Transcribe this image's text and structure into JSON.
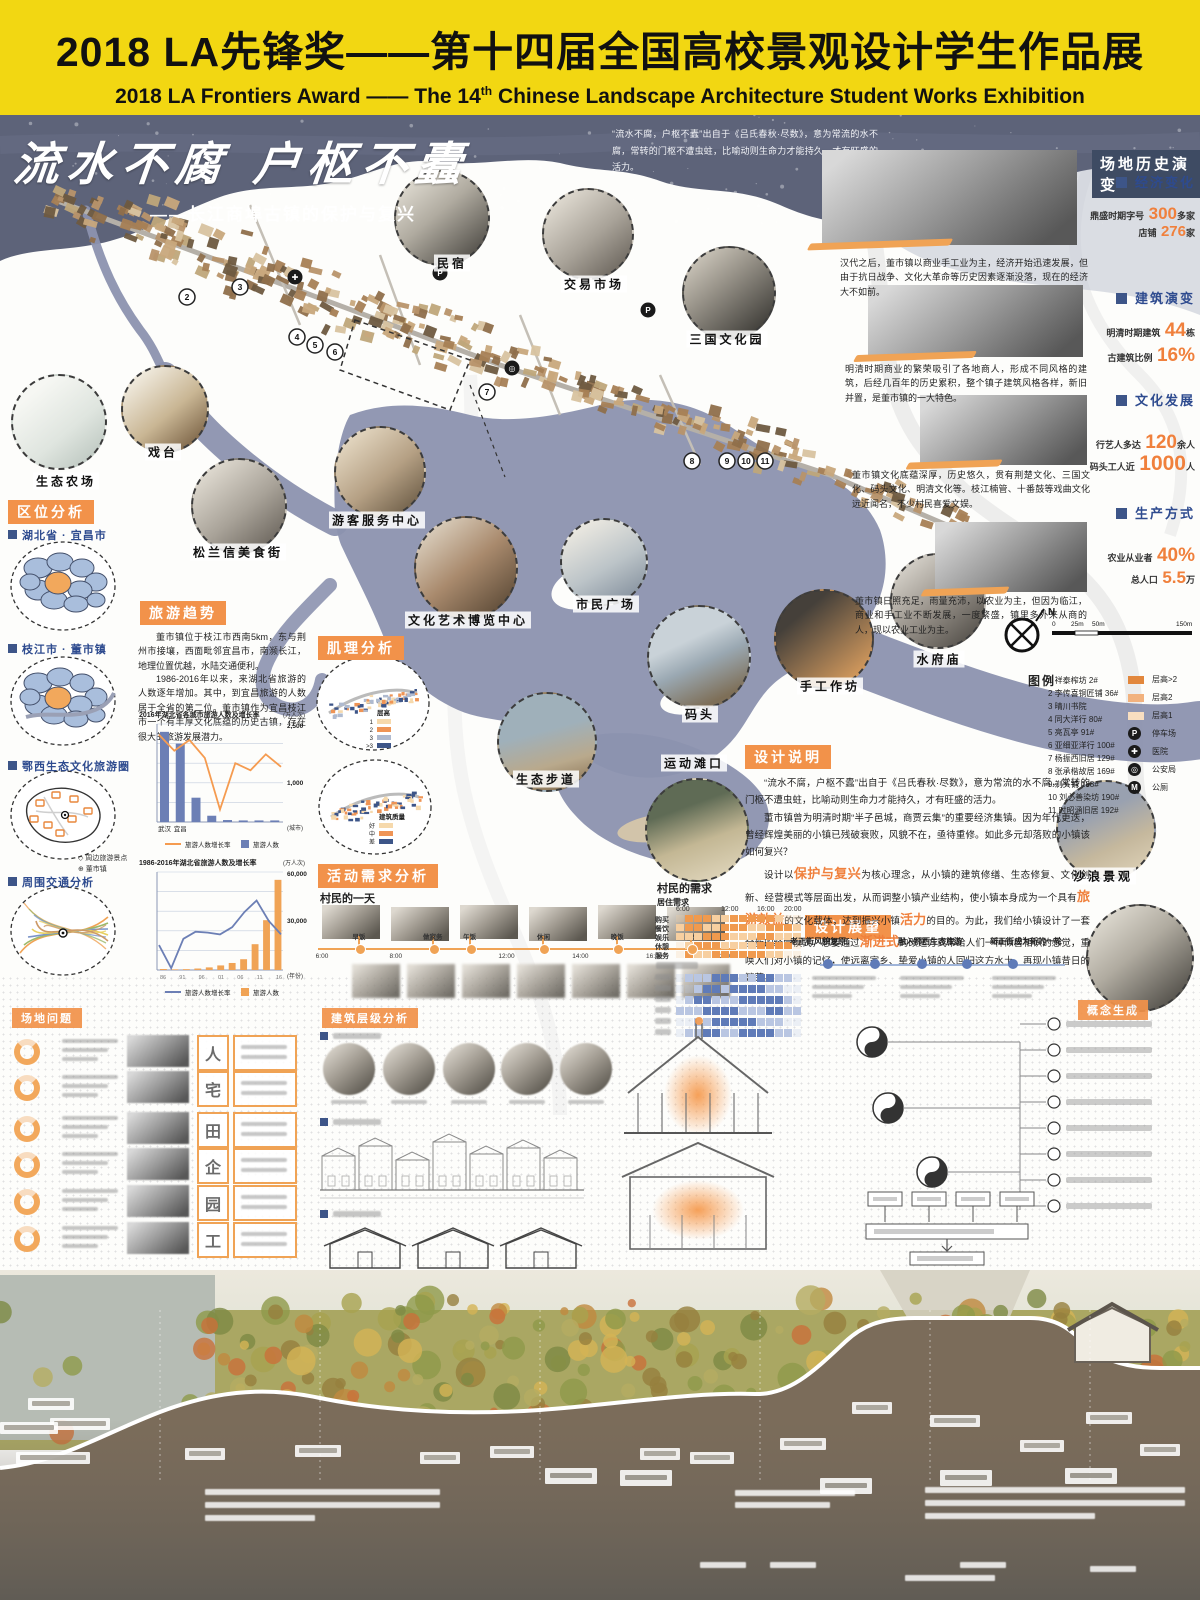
{
  "banner": {
    "title": "2018 LA先锋奖——第十四届全国高校景观设计学生作品展",
    "subtitle_pre": "2018 LA Frontiers Award —— The 14",
    "subtitle_sup": "th",
    "subtitle_post": " Chinese Landscape Architecture Student Works Exhibition",
    "bg_color": "#F2D712"
  },
  "hero": {
    "title": "流水不腐 户枢不蠹",
    "subtitle": "——长江商埠古镇的保护与复兴",
    "quote": "“流水不腐，户枢不蠹”出自于《吕氏春秋·尽数》，意为常流的水不腐，常转的门枢不遭虫蛀，比喻动则生命力才能持久，才有旺盛的活力。"
  },
  "map": {
    "callouts": [
      {
        "label": "民宿",
        "cx": 440,
        "cy": 216,
        "r": 46,
        "tone": "t-model",
        "lx": 452,
        "ly": 263
      },
      {
        "label": "交易市场",
        "cx": 586,
        "cy": 232,
        "r": 44,
        "tone": "t-gray",
        "lx": 594,
        "ly": 284
      },
      {
        "label": "三国文化园",
        "cx": 727,
        "cy": 291,
        "r": 45,
        "tone": "t-dark",
        "lx": 727,
        "ly": 339
      },
      {
        "label": "戏台",
        "cx": 163,
        "cy": 407,
        "r": 42,
        "tone": "t-pavilion",
        "lx": 163,
        "ly": 452
      },
      {
        "label": "生态农场",
        "cx": 57,
        "cy": 420,
        "r": 46,
        "tone": "t-farm",
        "lx": 66,
        "ly": 481
      },
      {
        "label": "松兰信美食街",
        "cx": 237,
        "cy": 504,
        "r": 46,
        "tone": "t-gray",
        "lx": 238,
        "ly": 552
      },
      {
        "label": "游客服务中心",
        "cx": 378,
        "cy": 470,
        "r": 44,
        "tone": "t-sepia",
        "lx": 377,
        "ly": 520
      },
      {
        "label": "文化艺术博览中心",
        "cx": 464,
        "cy": 566,
        "r": 50,
        "tone": "t-brick",
        "lx": 468,
        "ly": 620
      },
      {
        "label": "市民广场",
        "cx": 602,
        "cy": 560,
        "r": 42,
        "tone": "t-plaza",
        "lx": 606,
        "ly": 604
      },
      {
        "label": "码头",
        "cx": 697,
        "cy": 655,
        "r": 50,
        "tone": "t-pier",
        "lx": 700,
        "ly": 714
      },
      {
        "label": "手工作坊",
        "cx": 822,
        "cy": 637,
        "r": 48,
        "tone": "t-workshop",
        "lx": 830,
        "ly": 686
      },
      {
        "label": "水府庙",
        "cx": 936,
        "cy": 599,
        "r": 46,
        "tone": "t-temple",
        "lx": 939,
        "ly": 659
      },
      {
        "label": "生态步道",
        "cx": 545,
        "cy": 740,
        "r": 48,
        "tone": "t-lake",
        "lx": 546,
        "ly": 779
      },
      {
        "label": "运动滩口",
        "cx": 695,
        "cy": 828,
        "r": 50,
        "tone": "t-beach",
        "lx": 694,
        "ly": 763
      },
      {
        "label": "沙浪景观",
        "cx": 1104,
        "cy": 828,
        "r": 48,
        "tone": "t-waves",
        "lx": 1103,
        "ly": 876
      },
      {
        "label": "",
        "cx": 1138,
        "cy": 956,
        "r": 52,
        "tone": "t-model",
        "lx": 0,
        "ly": 0
      }
    ],
    "numbers": [
      {
        "n": "1",
        "x": 88,
        "y": 433
      },
      {
        "n": "2",
        "x": 187,
        "y": 297
      },
      {
        "n": "3",
        "x": 240,
        "y": 287
      },
      {
        "n": "4",
        "x": 297,
        "y": 337
      },
      {
        "n": "5",
        "x": 315,
        "y": 345
      },
      {
        "n": "6",
        "x": 335,
        "y": 352
      },
      {
        "n": "7",
        "x": 487,
        "y": 392
      },
      {
        "n": "8",
        "x": 692,
        "y": 461
      },
      {
        "n": "9",
        "x": 727,
        "y": 461
      },
      {
        "n": "10",
        "x": 746,
        "y": 461
      },
      {
        "n": "11",
        "x": 765,
        "y": 461
      }
    ],
    "poi": [
      {
        "g": "P",
        "x": 440,
        "y": 273
      },
      {
        "g": "P",
        "x": 648,
        "y": 310
      },
      {
        "g": "✚",
        "x": 295,
        "y": 277
      },
      {
        "g": "◎",
        "x": 512,
        "y": 368
      }
    ],
    "compass": "N",
    "scale_ticks": [
      "0",
      "25m",
      "50m",
      "150m"
    ]
  },
  "legend": {
    "header": "图例",
    "items": [
      "1  祥泰榨坊  2#",
      "2  李传喜铜匠铺  36#",
      "3  晴川书院",
      "4  同大洋行  80#",
      "5  亮瓦亭  91#",
      "6  亚细亚洋行  100#",
      "7  杨振西旧居  129#",
      "8  张承楷故居  169#",
      "9  剃头铺  188#",
      "10  刘必善染坊  190#",
      "11  时昭涵旧居  192#"
    ],
    "symbols": [
      {
        "type": "patch",
        "color": "#E2873C",
        "label": "层高>2"
      },
      {
        "type": "patch",
        "color": "#F2B27E",
        "label": "层高2"
      },
      {
        "type": "patch",
        "color": "#F8DEC0",
        "label": "层高1"
      },
      {
        "type": "circle",
        "glyph": "P",
        "label": "停车场"
      },
      {
        "type": "circle",
        "glyph": "✚",
        "label": "医院"
      },
      {
        "type": "circle",
        "glyph": "◎",
        "label": "公安局"
      },
      {
        "type": "circle",
        "glyph": "M",
        "label": "公厕"
      }
    ]
  },
  "location": {
    "header": "区位分析",
    "sections": [
      {
        "label": "湖北省 · 宜昌市"
      },
      {
        "label": "枝江市 · 董市镇"
      },
      {
        "label": "鄂西生态文化旅游圈",
        "legend": [
          "周边旅游景点",
          "董市镇"
        ]
      },
      {
        "label": "周围交通分析"
      }
    ]
  },
  "tourism": {
    "header": "旅游趋势",
    "p1": "董市镇位于枝江市西南5km，东与荆州市接壤，西面毗邻宜昌市，南濒长江，地理位置优越，水陆交通便利。",
    "p2": "1986-2016年以来，来湖北省旅游的人数逐年增加。其中，到宜昌旅游的人数居于全省的第二位。董市镇作为宜昌枝江市一个有丰厚文化底蕴的历史古镇，存在很大的旅游发展潜力。"
  },
  "texture": {
    "header": "肌理分析",
    "circle1": {
      "legend_title": "层高",
      "items": [
        {
          "label": "1",
          "color": "#F6D9AC"
        },
        {
          "label": "2",
          "color": "#EF9455"
        },
        {
          "label": "3",
          "color": "#AFBACF"
        },
        {
          "label": ">3",
          "color": "#3D5588"
        }
      ]
    },
    "circle2": {
      "legend_title": "建筑质量",
      "items": [
        {
          "label": "好",
          "color": "#F6D9AC"
        },
        {
          "label": "中",
          "color": "#EF9455"
        },
        {
          "label": "差",
          "color": "#3D5588"
        }
      ]
    }
  },
  "activity": {
    "header": "活动需求分析",
    "day_title": "村民的一天",
    "timeline": [
      {
        "label": "6:00",
        "type": "time"
      },
      {
        "label": "早饭",
        "type": "act"
      },
      {
        "label": "8:00",
        "type": "time"
      },
      {
        "label": "做家务",
        "type": "act"
      },
      {
        "label": "午饭",
        "type": "act"
      },
      {
        "label": "12:00",
        "type": "time"
      },
      {
        "label": "休闲",
        "type": "act"
      },
      {
        "label": "14:00",
        "type": "time"
      },
      {
        "label": "晚饭",
        "type": "act"
      },
      {
        "label": "16:00",
        "type": "time"
      },
      {
        "label": "睡觉",
        "type": "act"
      },
      {
        "label": "20:00",
        "type": "time"
      }
    ],
    "needs": {
      "title": "村民的需求",
      "group1": {
        "title": "居住需求",
        "times": [
          "6:00",
          "12:00",
          "16:00",
          "20:00"
        ],
        "rows": [
          {
            "label": "购买",
            "cells": "02221122222100"
          },
          {
            "label": "餐饮",
            "cells": "12211222112221"
          },
          {
            "label": "娱乐",
            "cells": "11122211122111"
          },
          {
            "label": "休憩",
            "cells": "01222111122220"
          },
          {
            "label": "服务",
            "cells": "02112222221100"
          }
        ]
      },
      "group2": {
        "rows": [
          "01112221122110",
          "00122122221100",
          "01221112222210",
          "11122221112211",
          "00112222211100",
          "01122112222110"
        ]
      }
    }
  },
  "history": {
    "header": "场地历史演变",
    "sections": [
      {
        "title": "经济变化",
        "stats": [
          {
            "pre": "鼎盛时期字号",
            "num": "300",
            "suf": "多家"
          },
          {
            "pre": "店铺",
            "num": "276",
            "suf": "家"
          }
        ],
        "para": "汉代之后，董市镇以商业手工业为主，经济开始迅速发展，但由于抗日战争、文化大革命等历史因素逐渐没落，现在的经济大不如前。"
      },
      {
        "title": "建筑演变",
        "stats": [
          {
            "pre": "明清时期建筑",
            "num": "44",
            "suf": "栋"
          },
          {
            "pre": "古建筑比例",
            "num": "16%",
            "suf": ""
          }
        ],
        "para": "明清时期商业的繁荣吸引了各地商人，形成不同风格的建筑，后经几百年的历史累积，整个镇子建筑风格各样，新旧并置，是董市镇的一大特色。"
      },
      {
        "title": "文化发展",
        "stats": [
          {
            "pre": "行艺人多达",
            "num": "120",
            "suf": "余人"
          },
          {
            "pre": "码头工人近",
            "num": "1000",
            "suf": "人"
          }
        ],
        "para": "董市镇文化底蕴深厚，历史悠久，贯有荆楚文化、三国文化、码头文化、明清文化等。枝江楠管、十番鼓等戏曲文化远近闻名，不少村民喜爱文娱。"
      },
      {
        "title": "生产方式",
        "stats": [
          {
            "pre": "农业从业者",
            "num": "40%",
            "suf": ""
          },
          {
            "pre": "总人口",
            "num": "5.5",
            "suf": "万"
          }
        ],
        "para": "董市镇日照充足，雨量充沛，以农业为主，但因为临江，商业和手工业不断发展，一度繁盛，镇里多外来从商的人，现以农业工业为主。"
      }
    ]
  },
  "design_note": {
    "header": "设计说明",
    "paragraphs": [
      [
        {
          "t": "“流水不腐，户枢不蠹”出自于《吕氏春秋·尽数》，意为常流的水不腐，常转的门枢不遭虫蛀，比喻动则生命力才能持久，才有旺盛的活力。"
        }
      ],
      [
        {
          "t": "董市镇曾为明清时期“半子邑城，商贾云集”的重要经济集镇。因为年代更迭，曾经辉煌美丽的小镇已残破衰败，风貌不在，亟待重修。如此多元却落败的小镇该如何复兴？"
        }
      ],
      [
        {
          "t": "设计以"
        },
        {
          "t": "保护与复兴",
          "hl": true
        },
        {
          "t": "为核心理念，从小镇的建筑修缮、生态修复、文化创新、经营模式等层面出发，从而调整小镇产业结构，使小镇本身成为一个具有"
        },
        {
          "t": "旅游效益",
          "hl": true
        },
        {
          "t": "的文化载体，达到振兴小镇"
        },
        {
          "t": "活力",
          "hl": true
        },
        {
          "t": "的目的。为此，我们给小镇设计了一套全新的经营模式，想要通过"
        },
        {
          "t": "渐进式",
          "hl": true
        },
        {
          "t": "的改造方式带给人们一种似曾相识的感觉，重唤人们对小镇的记忆，使远离家乡、挚爱小镇的人回归这方水土，再现小镇昔日的繁荣。"
        }
      ]
    ]
  },
  "vision": {
    "header": "设计展望",
    "milestones": [
      "老正街风貌复原，",
      "融入鄂西生态旅游",
      "新正街成为新的一轮"
    ]
  },
  "problems": {
    "header": "场地问题",
    "tags": [
      "人",
      "宅",
      "田",
      "企",
      "园",
      "工"
    ]
  },
  "building_analysis": {
    "header": "建筑层级分析"
  },
  "concept": {
    "header": "概念生成"
  },
  "chart_data": [
    {
      "type": "bar+line",
      "title": "2016年湖北省各城市旅游人数及增长率",
      "unit_right": "(万人次)",
      "right_axis_labels": [
        "2,500",
        "1,000"
      ],
      "x_note": "(城市)",
      "categories": [
        "武汉",
        "宜昌",
        "",
        "",
        "",
        "",
        "",
        ""
      ],
      "bar_values": [
        2300,
        2000,
        620,
        160,
        50,
        40,
        40,
        40
      ],
      "bar_max": 2500,
      "line_values": [
        88,
        70,
        82,
        62,
        4,
        56,
        48,
        66,
        52
      ],
      "legend": [
        {
          "label": "旅游人数增长率",
          "type": "line",
          "color": "#F59B50"
        },
        {
          "label": "旅游人数",
          "type": "bar",
          "color": "#6C7FB5"
        }
      ]
    },
    {
      "type": "bar+line",
      "title": "1986-2016年湖北省旅游人数及增长率",
      "unit_right": "(万人次)",
      "right_axis_labels": [
        "60,000",
        "30,000"
      ],
      "x_note": "(年份)",
      "x_ticks": [
        "86",
        "91",
        "96",
        "01",
        "06",
        "11",
        "16"
      ],
      "bar_values": [
        600,
        400,
        520,
        900,
        1600,
        2800,
        4300,
        6600,
        15800,
        30500,
        55200
      ],
      "bar_max": 60000,
      "line_values": [
        18,
        -8,
        25,
        33,
        32,
        30,
        38,
        55,
        68,
        45,
        30
      ],
      "legend": [
        {
          "label": "旅游人数增长率",
          "type": "line",
          "color": "#6C7FB5"
        },
        {
          "label": "旅游人数",
          "type": "bar",
          "color": "#F0A355"
        }
      ]
    }
  ]
}
